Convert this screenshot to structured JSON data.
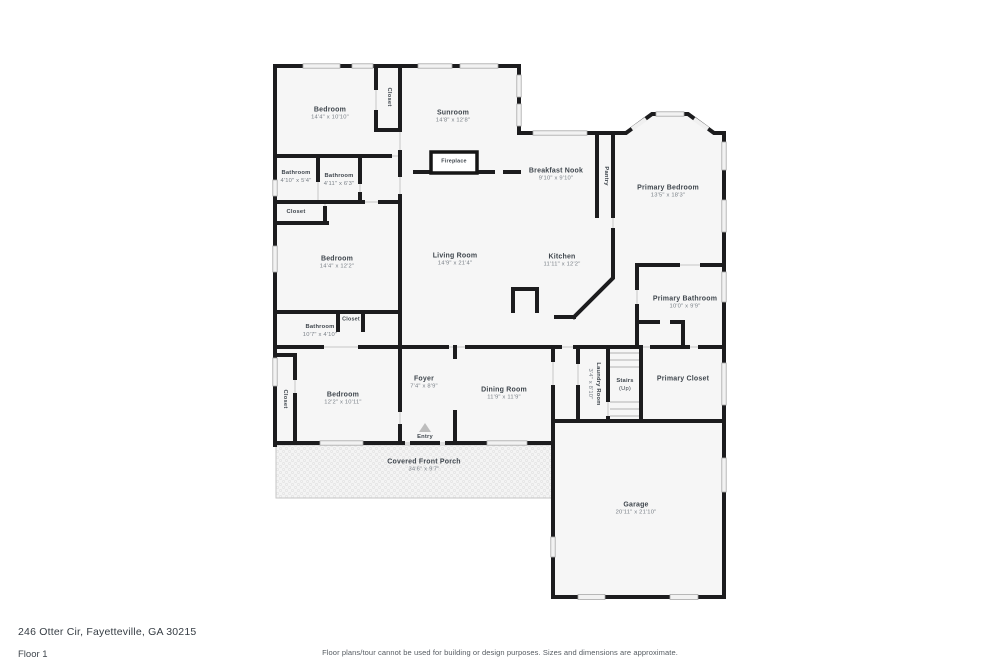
{
  "page": {
    "address": "246 Otter Cir, Fayetteville, GA 30215",
    "floor_label": "Floor 1",
    "disclaimer": "Floor plans/tour cannot be used for building or design purposes. Sizes and dimensions are approximate."
  },
  "colors": {
    "wall": "#1c1c1e",
    "room_fill": "#f6f6f6",
    "window_fill": "#f2f2f2",
    "label_text": "#3f464d",
    "dims_text": "#787f86"
  },
  "rooms": [
    {
      "id": "bedroom-1",
      "name": "Bedroom",
      "dims": "14'4\" x 10'10\""
    },
    {
      "id": "closet-1",
      "name": "Closet"
    },
    {
      "id": "sunroom",
      "name": "Sunroom",
      "dims": "14'8\" x 12'8\""
    },
    {
      "id": "fireplace",
      "name": "Fireplace"
    },
    {
      "id": "bathroom-1",
      "name": "Bathroom",
      "dims": "4'10\" x 5'4\""
    },
    {
      "id": "bathroom-2",
      "name": "Bathroom",
      "dims": "4'11\" x 6'3\""
    },
    {
      "id": "closet-2",
      "name": "Closet"
    },
    {
      "id": "breakfast-nook",
      "name": "Breakfast Nook",
      "dims": "9'10\" x 9'10\""
    },
    {
      "id": "pantry",
      "name": "Pantry"
    },
    {
      "id": "primary-bedroom",
      "name": "Primary Bedroom",
      "dims": "13'5\" x 18'3\""
    },
    {
      "id": "bedroom-2",
      "name": "Bedroom",
      "dims": "14'4\" x 12'2\""
    },
    {
      "id": "living-room",
      "name": "Living Room",
      "dims": "14'9\" x 21'4\""
    },
    {
      "id": "kitchen",
      "name": "Kitchen",
      "dims": "11'11\" x 12'2\""
    },
    {
      "id": "primary-bathroom",
      "name": "Primary Bathroom",
      "dims": "10'0\" x 9'9\""
    },
    {
      "id": "closet-3",
      "name": "Closet"
    },
    {
      "id": "bathroom-3",
      "name": "Bathroom",
      "dims": "10'7\" x 4'10\""
    },
    {
      "id": "closet-4",
      "name": "Closet"
    },
    {
      "id": "bedroom-3",
      "name": "Bedroom",
      "dims": "12'2\" x 10'11\""
    },
    {
      "id": "foyer",
      "name": "Foyer",
      "dims": "7'4\" x 8'9\""
    },
    {
      "id": "dining-room",
      "name": "Dining Room",
      "dims": "11'9\" x 11'9\""
    },
    {
      "id": "laundry-room",
      "name": "Laundry Room",
      "dims": "3'4\" x 8'10\""
    },
    {
      "id": "stairs",
      "name": "Stairs",
      "dims": "(Up)"
    },
    {
      "id": "primary-closet",
      "name": "Primary Closet"
    },
    {
      "id": "entry",
      "name": "Entry"
    },
    {
      "id": "covered-front-porch",
      "name": "Covered Front Porch",
      "dims": "34'6\" x 9'7\""
    },
    {
      "id": "garage",
      "name": "Garage",
      "dims": "20'11\" x 21'10\""
    }
  ]
}
